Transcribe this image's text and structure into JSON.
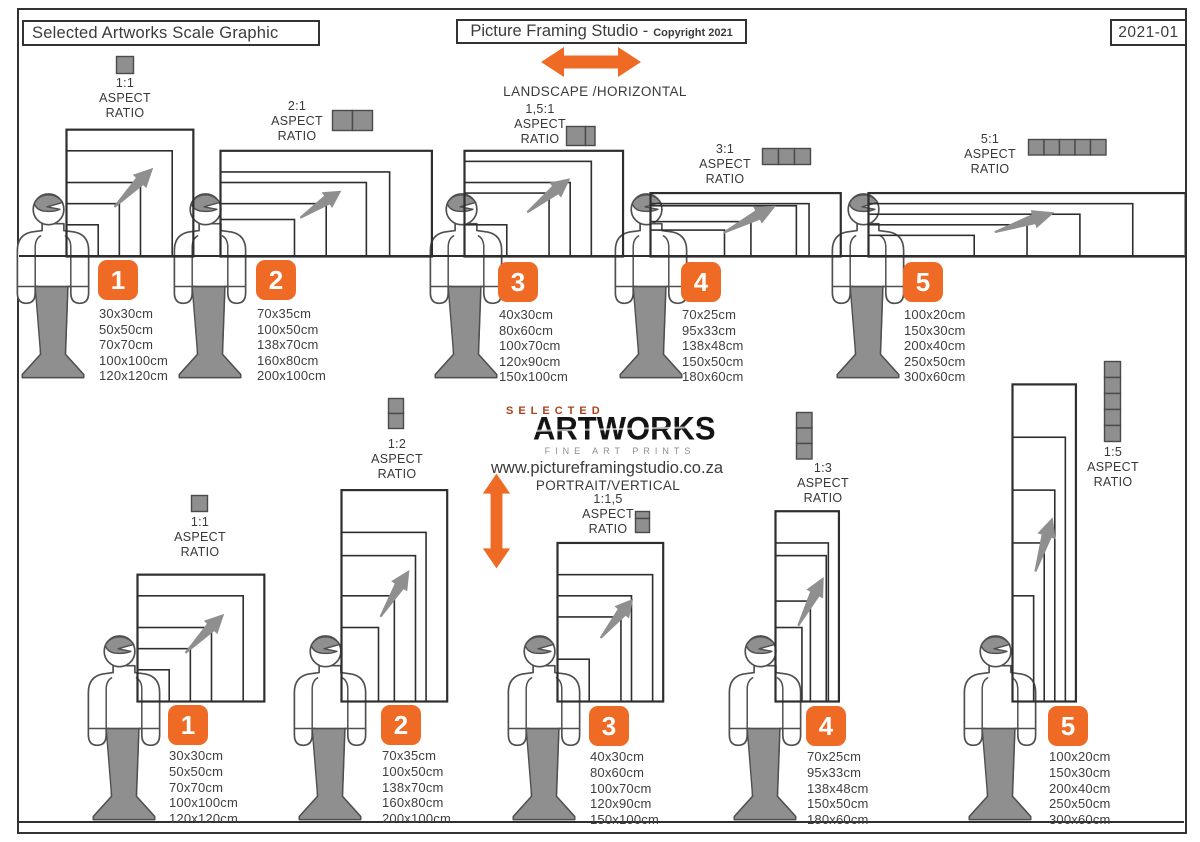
{
  "header": {
    "left_title": "Selected Artworks Scale Graphic",
    "center_title": "Picture Framing Studio -",
    "center_subtitle": "Copyright 2021",
    "right_code": "2021-01"
  },
  "strings": {
    "aspect": "ASPECT",
    "ratio": "RATIO",
    "landscape": "LANDSCAPE /HORIZONTAL",
    "portrait": "PORTRAIT/VERTICAL"
  },
  "logo": {
    "top": "SELECTED",
    "main": "ARTWORKS",
    "tagline": "FINE ART PRINTS",
    "website": "www.pictureframingstudio.co.za"
  },
  "colors": {
    "orange": "#EF6A24",
    "gray": "#8F8F8F",
    "rust": "#A8431C",
    "ink": "#2E2E2E"
  },
  "landscape_groups": [
    {
      "number": "1",
      "ratio": "1:1",
      "units": 1,
      "sizes": [
        "30x30cm",
        "50x50cm",
        "70x70cm",
        "100x100cm",
        "120x120cm"
      ]
    },
    {
      "number": "2",
      "ratio": "2:1",
      "units": 2,
      "sizes": [
        "70x35cm",
        "100x50cm",
        "138x70cm",
        "160x80cm",
        "200x100cm"
      ]
    },
    {
      "number": "3",
      "ratio": "1,5:1",
      "units": 1.5,
      "sizes": [
        "40x30cm",
        "80x60cm",
        "100x70cm",
        "120x90cm",
        "150x100cm"
      ]
    },
    {
      "number": "4",
      "ratio": "3:1",
      "units": 3,
      "sizes": [
        "70x25cm",
        "95x33cm",
        "138x48cm",
        "150x50cm",
        "180x60cm"
      ]
    },
    {
      "number": "5",
      "ratio": "5:1",
      "units": 5,
      "sizes": [
        "100x20cm",
        "150x30cm",
        "200x40cm",
        "250x50cm",
        "300x60cm"
      ]
    }
  ],
  "portrait_groups": [
    {
      "number": "1",
      "ratio": "1:1",
      "units": 1,
      "sizes": [
        "30x30cm",
        "50x50cm",
        "70x70cm",
        "100x100cm",
        "120x120cm"
      ]
    },
    {
      "number": "2",
      "ratio": "1:2",
      "units": 2,
      "sizes": [
        "70x35cm",
        "100x50cm",
        "138x70cm",
        "160x80cm",
        "200x100cm"
      ]
    },
    {
      "number": "3",
      "ratio": "1:1,5",
      "units": 1.5,
      "sizes": [
        "40x30cm",
        "80x60cm",
        "100x70cm",
        "120x90cm",
        "150x100cm"
      ]
    },
    {
      "number": "4",
      "ratio": "1:3",
      "units": 3,
      "sizes": [
        "70x25cm",
        "95x33cm",
        "138x48cm",
        "150x50cm",
        "180x60cm"
      ]
    },
    {
      "number": "5",
      "ratio": "1:5",
      "units": 5,
      "sizes": [
        "100x20cm",
        "150x30cm",
        "200x40cm",
        "250x50cm",
        "300x60cm"
      ]
    }
  ]
}
